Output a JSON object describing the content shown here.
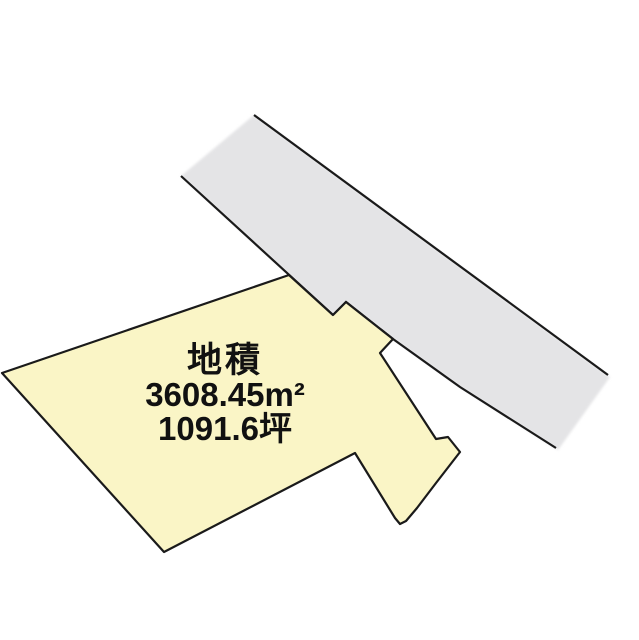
{
  "canvas": {
    "width": 639,
    "height": 640,
    "background_color": "#FFFFFF"
  },
  "parcel": {
    "label": {
      "title": "地積",
      "area_m2": "3608.45m²",
      "area_tsubo": "1091.6坪"
    },
    "fill_color": "#FAF5C6",
    "outline_color": "#1A1A1A",
    "points": "2,373 289,275 333,315 346,302 393,339 380,353 436,439 448,437 460,452 436,483 417,508 406,521 400,524 395,518 355,453 164,552"
  },
  "road": {
    "fill_color": "#E4E4E6",
    "edge_color": "#1A1A1A",
    "fill_points": "254,115 610,377 558,450 460,387 393,339 346,302 333,315 181,176",
    "top_edge_points": "254,115 608,375",
    "bottom_edge_points": "181,176 333,315 346,302 393,339 460,387 556,448"
  }
}
